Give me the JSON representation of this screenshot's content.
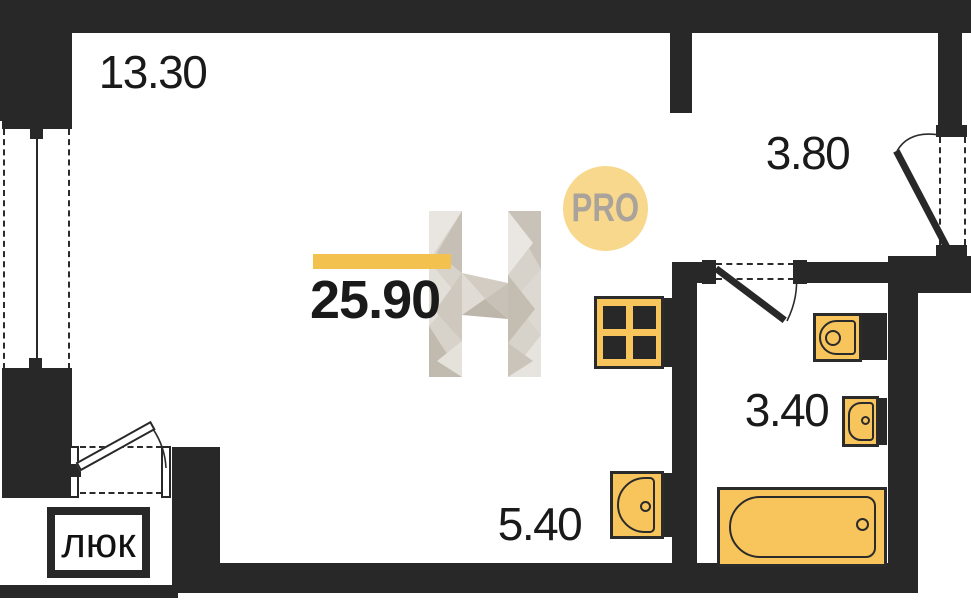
{
  "floorplan": {
    "total_area_label": "25.90",
    "rooms": {
      "living": "13.30",
      "hall": "3.80",
      "bathroom": "3.40",
      "kitchen": "5.40"
    },
    "hatch_label": "люк",
    "badge_label": "PRO",
    "icons": {
      "stove": "stove-icon",
      "kitchen_sink": "sink-icon",
      "bathroom_sink": "sink-icon",
      "small_sink": "sink-icon",
      "washer": "washer-block",
      "bathtub": "bathtub-icon",
      "watermark_letter": "h-logo-watermark"
    },
    "colors": {
      "wall": "#282828",
      "fixture_fill": "#F7C55C",
      "fixture_stroke": "#2B2B2B",
      "accent_bar": "#F2C14E",
      "badge_fill": "#F8D88C",
      "badge_text": "#A9A39B",
      "label_text": "#1A1A1A"
    }
  }
}
